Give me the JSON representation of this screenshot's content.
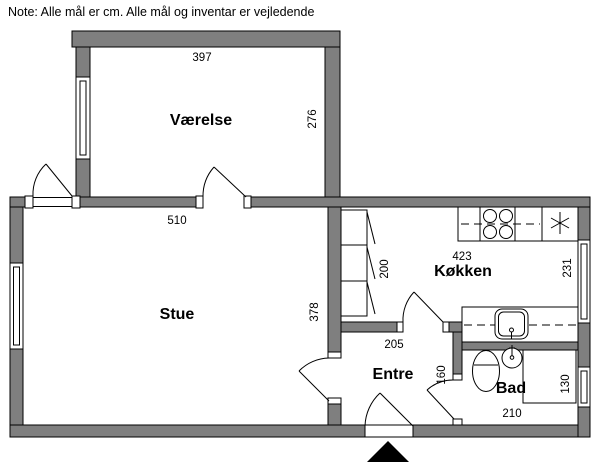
{
  "note": "Note: Alle mål er cm. Alle mål og inventar er vejledende",
  "rooms": {
    "vaerelse": {
      "label": "Værelse",
      "width_cm": "397",
      "depth_cm": "276"
    },
    "stue": {
      "label": "Stue",
      "width_cm": "510",
      "depth_cm": "378"
    },
    "koekken": {
      "label": "Køkken",
      "width_cm": "423",
      "depth_cm": "231",
      "wardrobe_cm": "200"
    },
    "entre": {
      "label": "Entre",
      "width_cm": "205",
      "depth_cm": "160"
    },
    "bad": {
      "label": "Bad",
      "width_cm": "210",
      "depth_cm": "130"
    }
  },
  "colors": {
    "wall_fill": "#7f7f7f",
    "line": "#000000",
    "background": "#ffffff"
  },
  "icons": {
    "stove": "stove-burners-icon",
    "cooktop_star": "cooktop-star-icon",
    "kitchen_sink": "kitchen-sink-icon",
    "toilet": "toilet-icon",
    "washbasin": "washbasin-icon",
    "shower": "shower-icon",
    "wardrobe": "wardrobe-icon",
    "entrance_marker": "entrance-arrow-icon"
  }
}
